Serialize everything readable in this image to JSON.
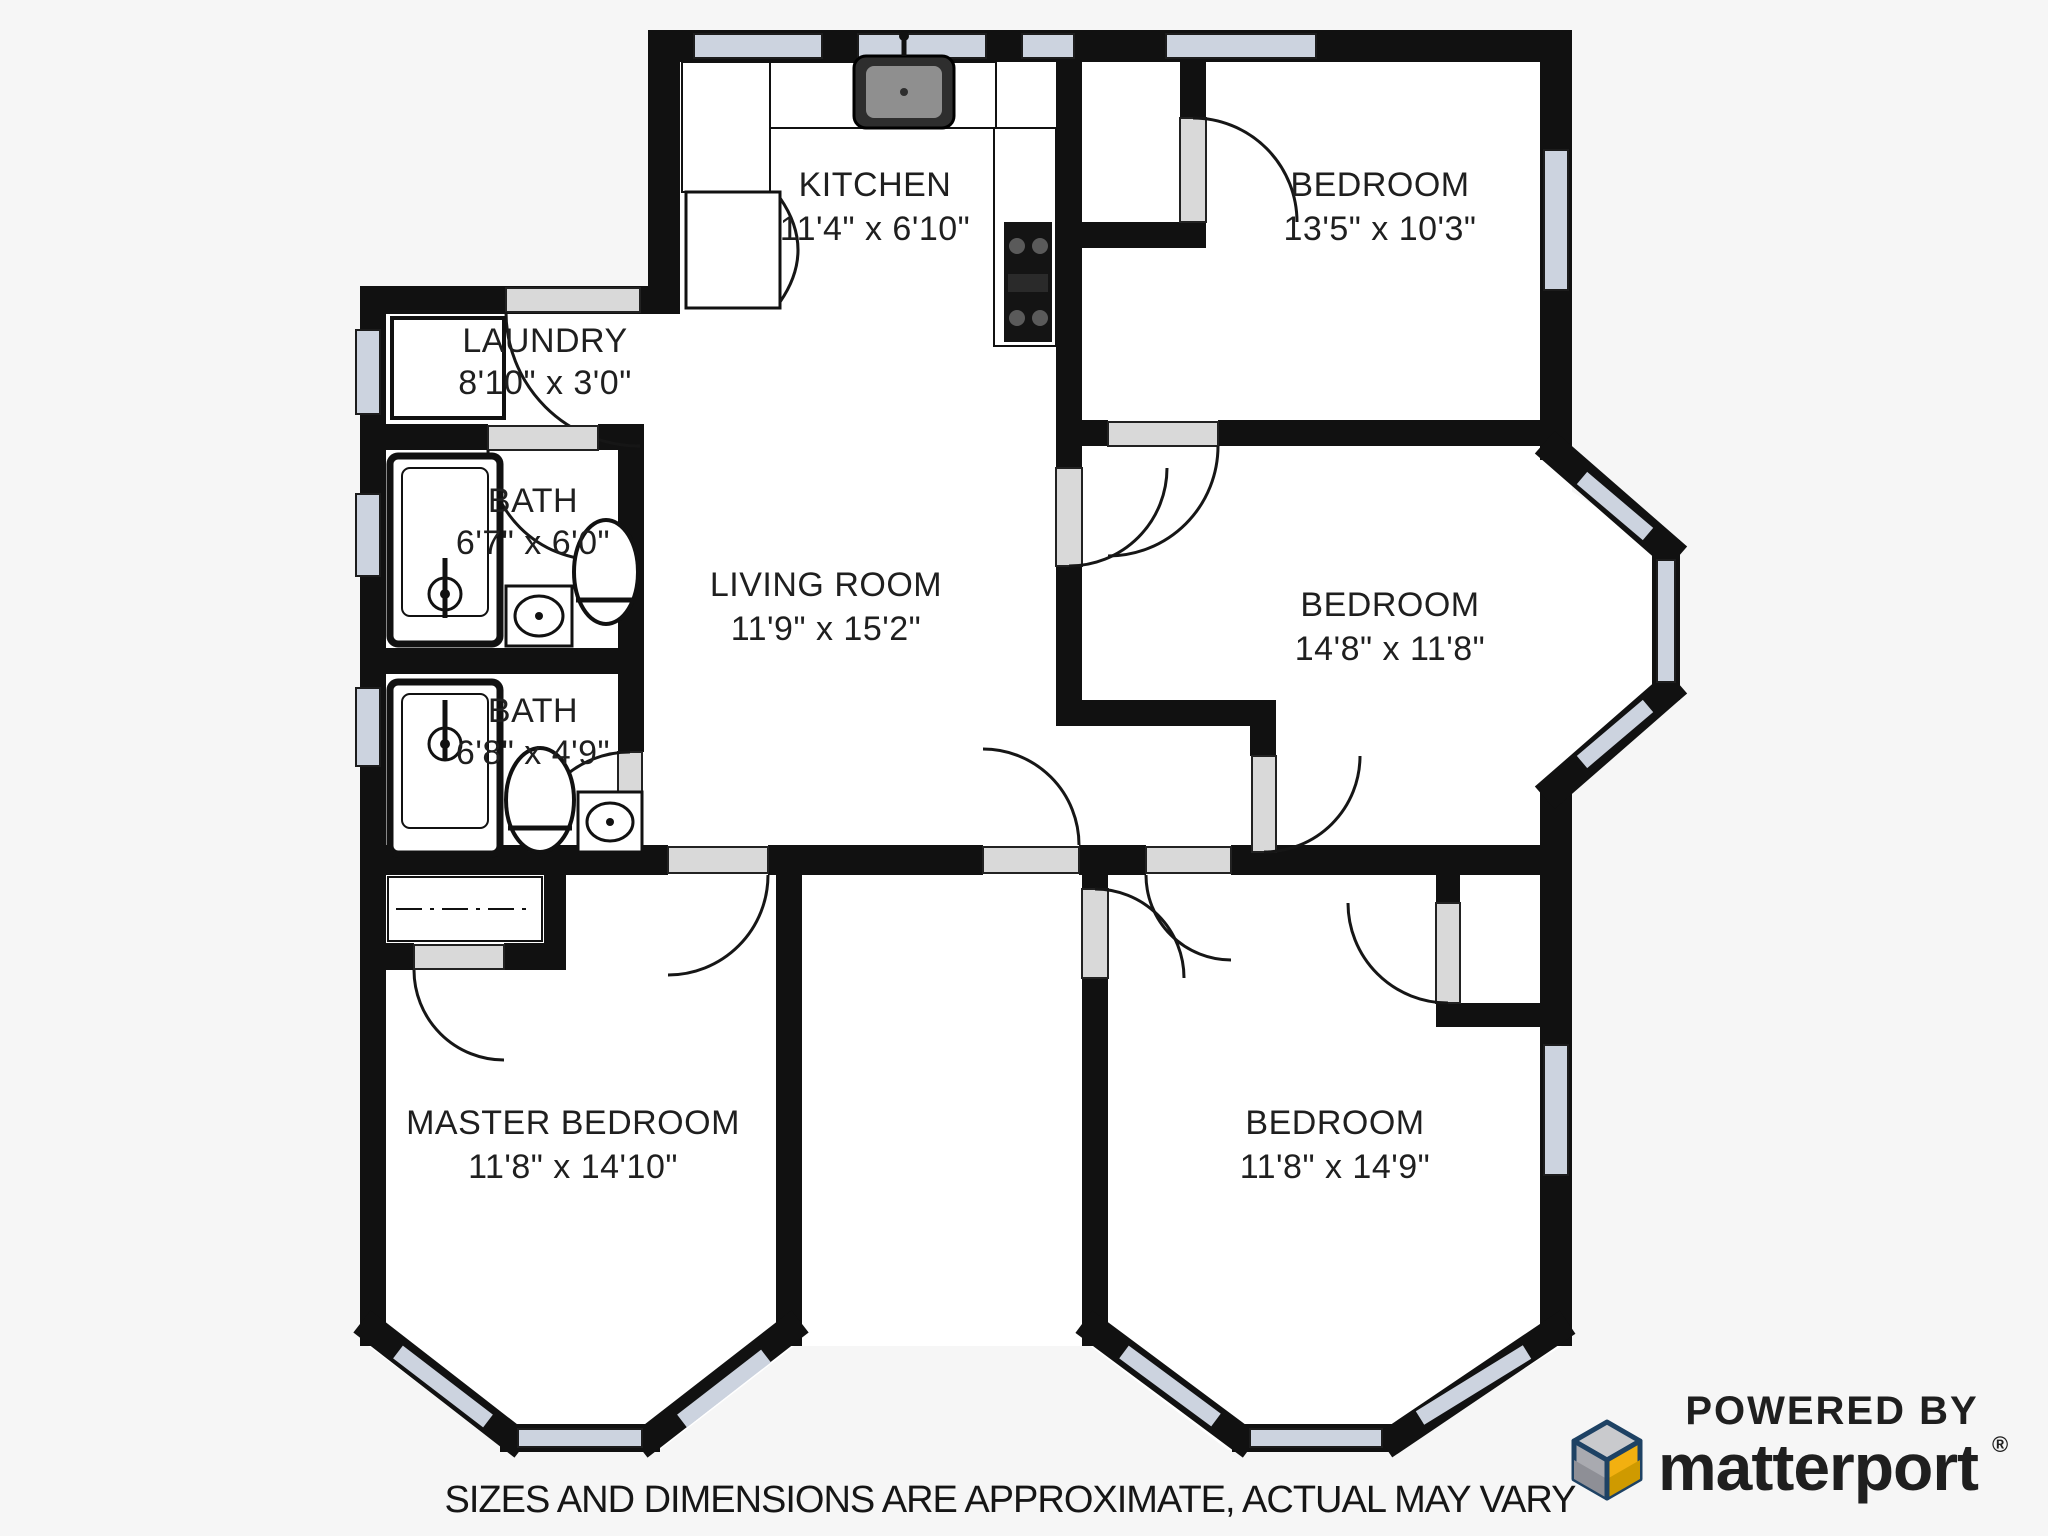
{
  "rooms": {
    "kitchen": {
      "name": "KITCHEN",
      "dims": "11'4\" x 6'10\""
    },
    "bedroom_top": {
      "name": "BEDROOM",
      "dims": "13'5\" x 10'3\""
    },
    "laundry": {
      "name": "LAUNDRY",
      "dims": "8'10\" x 3'0\""
    },
    "bath_upper": {
      "name": "BATH",
      "dims": "6'7\" x 6'0\""
    },
    "living_room": {
      "name": "LIVING ROOM",
      "dims": "11'9\" x 15'2\""
    },
    "bedroom_middle": {
      "name": "BEDROOM",
      "dims": "14'8\" x 11'8\""
    },
    "bath_lower": {
      "name": "BATH",
      "dims": "6'8\" x 4'9\""
    },
    "master_bedroom": {
      "name": "MASTER BEDROOM",
      "dims": "11'8\" x 14'10\""
    },
    "bedroom_bottom": {
      "name": "BEDROOM",
      "dims": "11'8\" x 14'9\""
    }
  },
  "footer": {
    "disclaimer": "SIZES AND DIMENSIONS ARE APPROXIMATE, ACTUAL MAY VARY"
  },
  "logo": {
    "powered_by": "POWERED BY",
    "brand": "matterport",
    "registered": "®"
  },
  "colors": {
    "wall": "#111111",
    "floor": "#ffffff",
    "background": "#f6f6f6",
    "window": "#ccd3df",
    "door": "#d9d9d9",
    "text": "#1f1f1f",
    "navy": "#1e4264",
    "yellow": "#f2b010",
    "yellow_dark": "#cf9a00",
    "gray_light": "#c9cacd",
    "gray_dark": "#8e8f96"
  }
}
